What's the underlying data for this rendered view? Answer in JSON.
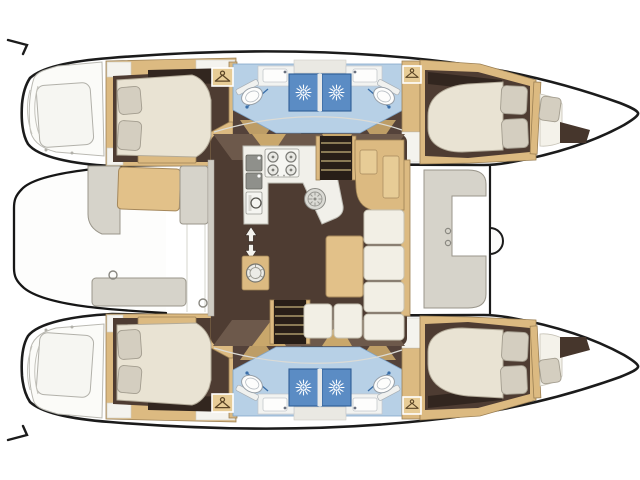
{
  "page": {
    "background": "#ffffff",
    "description": "Top-down interior deck plan of a sailing catamaran, bows pointing right"
  },
  "colors": {
    "background": "#ffffff",
    "outline": "#1b1b1b",
    "wood": "#dcba81",
    "wood-edge": "#9c8054",
    "table": "#e2c189",
    "floor": "#4e3c32",
    "floor-light": "#6d594b",
    "floor-deep": "#32261f",
    "mattress": "#e9e3d3",
    "mattress-edge": "#b3ab99",
    "pillow": "#d4cec0",
    "pillow-edge": "#a39d8f",
    "cushion": "#f2efe5",
    "cushion-edge": "#c6c2b2",
    "tile": "#b7d0e6",
    "shower": "#5b8cc4",
    "shower-edge": "#2f5e96",
    "fixture": "#fdfdfc",
    "bench": "#d6d3ca",
    "bench-edge": "#9a968b",
    "steel": "#8f908b"
  },
  "vessel": {
    "type": "catamaran",
    "view": "top-down floor plan",
    "bow_direction": "right",
    "layout_summary": "4 double cabins, 4 shower rooms, central saloon with galley and dinette, aft cockpit, forward cockpit, twin transom steps",
    "areas": [
      {
        "name": "aft-platform"
      },
      {
        "name": "aft-cockpit",
        "features": [
          "bench-seats",
          "seat-cushion"
        ]
      },
      {
        "name": "port-transom-steps"
      },
      {
        "name": "port-aft-cabin",
        "features": [
          "double-berth",
          "two-pillows",
          "wardrobe"
        ]
      },
      {
        "name": "port-aft-bathroom",
        "features": [
          "toilet",
          "washbasin",
          "shower-stall"
        ]
      },
      {
        "name": "port-forward-bathroom",
        "features": [
          "toilet",
          "washbasin",
          "shower-stall"
        ]
      },
      {
        "name": "port-forward-cabin",
        "features": [
          "double-berth",
          "two-pillows",
          "wardrobe"
        ]
      },
      {
        "name": "port-forepeak",
        "features": [
          "crew-berth"
        ]
      },
      {
        "name": "saloon",
        "features": [
          "galley",
          "dinette",
          "nav-console",
          "companionway-stairs-port",
          "companionway-stairs-starboard",
          "washing-machine"
        ]
      },
      {
        "name": "galley",
        "features": [
          "four-burner-stove",
          "double-sink",
          "oven",
          "round-sink",
          "aft-counter-sink",
          "floor-grate"
        ]
      },
      {
        "name": "forward-cockpit",
        "features": [
          "c-shaped-bench"
        ]
      },
      {
        "name": "foredeck",
        "features": [
          "crossbeam",
          "windlass"
        ]
      },
      {
        "name": "starboard-transom-steps"
      },
      {
        "name": "starboard-aft-cabin",
        "features": [
          "double-berth",
          "two-pillows",
          "wardrobe"
        ]
      },
      {
        "name": "starboard-aft-bathroom",
        "features": [
          "toilet",
          "washbasin",
          "shower-stall"
        ]
      },
      {
        "name": "starboard-forward-bathroom",
        "features": [
          "toilet",
          "washbasin",
          "shower-stall"
        ]
      },
      {
        "name": "starboard-forward-cabin",
        "features": [
          "double-berth",
          "two-pillows",
          "wardrobe"
        ]
      },
      {
        "name": "starboard-forepeak",
        "features": [
          "crew-berth"
        ]
      }
    ]
  },
  "icons": [
    {
      "name": "shower-sunburst-icon",
      "count": 4
    },
    {
      "name": "hanger-icon",
      "count": 4
    },
    {
      "name": "toilet-icon",
      "count": 4
    },
    {
      "name": "washbasin-icon",
      "count": 4
    },
    {
      "name": "stove-burners-icon",
      "burners": 4
    },
    {
      "name": "washing-machine-icon",
      "count": 1
    },
    {
      "name": "round-sink-icon",
      "count": 2
    },
    {
      "name": "oven-icon",
      "count": 1
    },
    {
      "name": "companionway-arrows-icon",
      "count": 1
    },
    {
      "name": "windlass-icon",
      "count": 1
    }
  ]
}
